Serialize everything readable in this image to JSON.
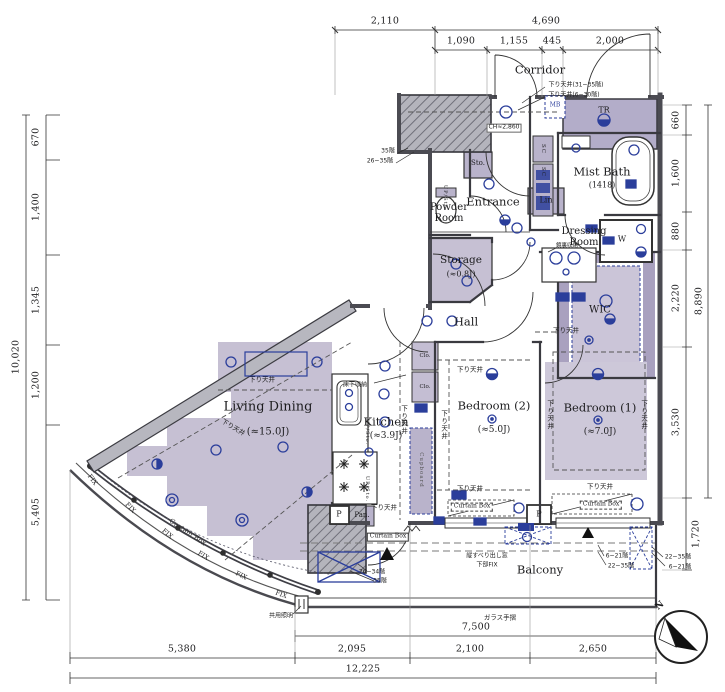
{
  "dims": {
    "top_total_left": "2,110",
    "top_total_right": "4,690",
    "top_sub": [
      "1,090",
      "1,155",
      "445",
      "2,000"
    ],
    "left": [
      "670",
      "1,400",
      "1,345",
      "1,200",
      "5,405"
    ],
    "left_total": "10,020",
    "right": [
      "660",
      "1,600",
      "880",
      "2,220",
      "3,530"
    ],
    "right_total": "8,890",
    "right_balcony": "1,720",
    "bottom_glass": "7,500",
    "bottom_sub": [
      "5,380",
      "2,095",
      "2,100",
      "2,650"
    ],
    "bottom_total": "12,225"
  },
  "rooms": {
    "corridor": "Corridor",
    "entrance": "Entrance",
    "powder": "Powder Room",
    "storage": "Storage",
    "storage_size": "(≈0.8J)",
    "mist_bath": "Mist Bath",
    "mist_bath_size": "(1418)",
    "dressing": "Dressing Room",
    "hall": "Hall",
    "wic": "WIC",
    "kitchen": "Kitchen",
    "kitchen_size": "(≈3.9J)",
    "living": "Living Dining",
    "living_size": "(≈15.0J)",
    "bed2": "Bedroom (2)",
    "bed2_size": "(≈5.0J)",
    "bed1": "Bedroom (1)",
    "bed1_size": "(≈7.0J)",
    "balcony": "Balcony",
    "tr": "TR",
    "sto": "Sto.",
    "lin": "Lin",
    "w": "W",
    "p": "P",
    "pan": "Pan.",
    "sc": "SC",
    "clo": "Clo.",
    "mb": "MB",
    "cupboard": "Cupboard",
    "up_sto": "UP/Sto."
  },
  "annotations": {
    "drop_ceiling": "下り天井",
    "drop_ceiling_hi": "下り天井(31~35階)",
    "drop_ceiling_lo": "下り天井(6~30階)",
    "ch": "CH≈2,860",
    "underfloor": "床下収納",
    "mirror": "鏡裏収納",
    "glass_rail": "ガラス手摺",
    "common_light": "共用照明",
    "curtain_box": "Curtain Box",
    "fix": "FIX",
    "casement": "縦すべり出し窓",
    "lower_fix": "下部FIX",
    "f26_35": "26~35階",
    "f35": "35階",
    "f26_34": "26~34階",
    "f6_21": "6~21階",
    "f22_35": "22~35階",
    "north": "N"
  }
}
